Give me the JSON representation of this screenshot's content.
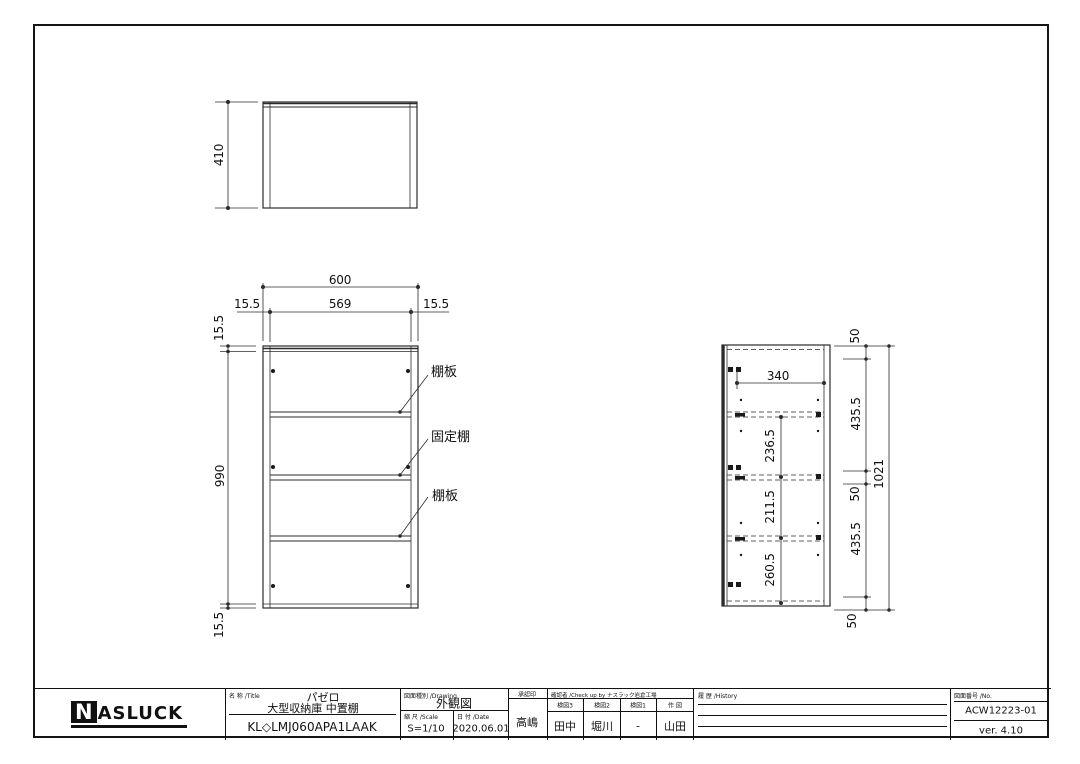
{
  "sheet": {
    "bg": "#ffffff",
    "line_color": "#2b2b2b"
  },
  "top_view": {
    "height": "410"
  },
  "front_view": {
    "overall_width": "600",
    "inner_width": "569",
    "left_side_thickness": "15.5",
    "right_side_thickness": "15.5",
    "top_panel_thickness": "15.5",
    "overall_height": "990",
    "bottom_panel_thickness": "15.5",
    "shelf_label_upper": "棚板",
    "fixed_shelf_label": "固定棚",
    "shelf_label_lower": "棚板"
  },
  "side_view": {
    "pin_pitch_width": "340",
    "opening_upper": "236.5",
    "opening_middle": "211.5",
    "opening_lower": "260.5",
    "segment_top": "50",
    "segment_upper": "435.5",
    "segment_middle": "50",
    "segment_lower": "435.5",
    "segment_bottom": "50",
    "overall_height": "1021"
  },
  "title_block": {
    "logo_n": "N",
    "logo_rest": "ASLUCK",
    "name_label": "名 称 /Title",
    "series_name": "パゼロ",
    "product_name": "大型収納庫 中置棚",
    "model_code": "KL◇LMJ060APA1LAAK",
    "drawing_label": "図面種別 /Drawing",
    "drawing_type": "外観図",
    "scale_label": "縮 尺 /Scale",
    "scale_value": "S=1/10",
    "date_label": "日 付 /Date",
    "date_value": "2020.06.01",
    "approval_label": "承認印",
    "approval_name": "高嶋",
    "check_header": "確認者 /Check up by ナスラック岩倉工場",
    "check_cols": [
      {
        "label": "検図3",
        "value": "田中"
      },
      {
        "label": "検図2",
        "value": "堀川"
      },
      {
        "label": "検図1",
        "value": "-"
      },
      {
        "label": "作 図",
        "value": "山田"
      }
    ],
    "history_label": "履 歴 /History",
    "no_label": "図面番号 /No.",
    "drawing_no": "ACW12223-01",
    "version": "ver. 4.10"
  }
}
